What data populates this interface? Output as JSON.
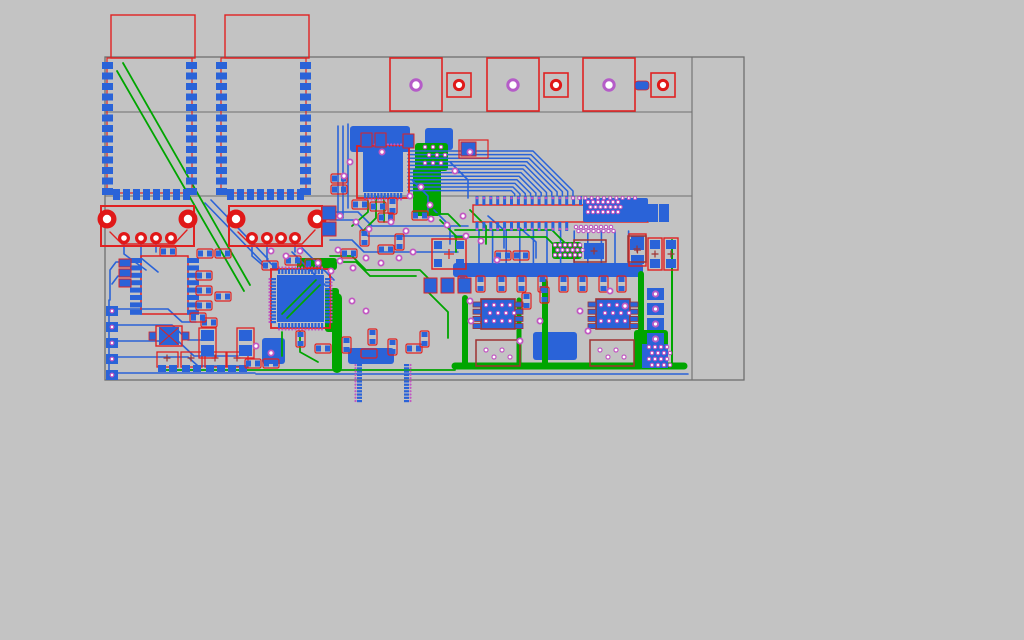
{
  "app": {
    "name": "pcb-layout-viewer"
  },
  "pcb": {
    "canvas": {
      "width": 1024,
      "height": 640,
      "background": "#c3c3c3"
    },
    "palette": {
      "board_outline": "#6f6f6f",
      "top_copper": "#2a63d8",
      "bottom_copper": "#00a500",
      "silkscreen": "#e02222",
      "silkscreen_dark": "#a03333",
      "via_ring": "#c257c2",
      "violet_ring": "#b55cc8",
      "hole_fill": "#ffffff",
      "drill_red": "#e01818"
    },
    "board": {
      "outer": {
        "x": 105,
        "y": 57,
        "w": 639,
        "h": 323
      },
      "vlines": [
        [
          692,
          57,
          692,
          380
        ]
      ],
      "hlines": [
        [
          105,
          112,
          692,
          112
        ],
        [
          105,
          196,
          692,
          196
        ]
      ]
    },
    "wifi_modules": [
      {
        "x": 107,
        "y": 58,
        "w": 85,
        "h": 135,
        "courtyard": {
          "x": 111,
          "y": 15,
          "w": 84,
          "h": 43
        }
      },
      {
        "x": 221,
        "y": 58,
        "w": 85,
        "h": 135,
        "courtyard": {
          "x": 225,
          "y": 15,
          "w": 84,
          "h": 43
        }
      }
    ],
    "mount_pads_large": [
      {
        "x": 390,
        "y": 58,
        "s": 52
      },
      {
        "x": 487,
        "y": 58,
        "s": 52
      },
      {
        "x": 583,
        "y": 58,
        "s": 52
      }
    ],
    "mount_pads_small": [
      {
        "x": 447,
        "y": 73,
        "s": 24
      },
      {
        "x": 544,
        "y": 73,
        "s": 24
      },
      {
        "x": 651,
        "y": 73,
        "s": 24
      }
    ],
    "mini_pad": {
      "x": 635,
      "y": 81,
      "w": 14,
      "h": 9
    },
    "usb_connectors": [
      {
        "x": 101,
        "y": 206,
        "w": 93,
        "h": 40,
        "holes": [
          [
            107,
            219
          ],
          [
            188,
            219
          ]
        ],
        "pins": [
          [
            124,
            238
          ],
          [
            141,
            238
          ],
          [
            156,
            238
          ],
          [
            171,
            238
          ]
        ],
        "trap": "110,232 122,244 174,244 187,230"
      },
      {
        "x": 229,
        "y": 206,
        "w": 93,
        "h": 40,
        "holes": [
          [
            236,
            219
          ],
          [
            317,
            219
          ]
        ],
        "pins": [
          [
            252,
            238
          ],
          [
            267,
            238
          ],
          [
            281,
            238
          ],
          [
            295,
            238
          ]
        ],
        "trap": "238,232 250,244 302,244 315,230"
      }
    ],
    "qfps": [
      {
        "x": 357,
        "y": 146,
        "s": 52,
        "pins": 12,
        "diag": false
      },
      {
        "x": 271,
        "y": 269,
        "s": 59,
        "pins": 14,
        "diag": true
      }
    ],
    "soic16": {
      "x": 141,
      "y": 256,
      "w": 47,
      "h": 58,
      "pads": 8
    },
    "soic8": [
      {
        "x": 481,
        "y": 299,
        "w": 34,
        "h": 30
      },
      {
        "x": 596,
        "y": 299,
        "w": 34,
        "h": 30
      }
    ],
    "header": {
      "x": 473,
      "y": 205,
      "w": 175,
      "h": 17,
      "top_pins": 16,
      "bottom_pins": 14,
      "pitch": 6.9
    },
    "castellated_block": {
      "x": 583,
      "y": 198,
      "w": 65,
      "h": 24
    },
    "tall_pads": [
      [
        648,
        204,
        10,
        18
      ],
      [
        659,
        204,
        10,
        18
      ]
    ],
    "elco_caps": [
      {
        "x": 629,
        "y": 234,
        "w": 17,
        "h": 32
      },
      {
        "x": 648,
        "y": 238,
        "w": 14,
        "h": 32
      },
      {
        "x": 664,
        "y": 238,
        "w": 14,
        "h": 32
      }
    ],
    "caps_small": [
      {
        "x": 157,
        "y": 352
      },
      {
        "x": 181,
        "y": 352
      },
      {
        "x": 205,
        "y": 352
      },
      {
        "x": 227,
        "y": 352
      }
    ],
    "red_boxes": [
      {
        "x": 476,
        "y": 340,
        "w": 44,
        "h": 26,
        "dots": true
      },
      {
        "x": 590,
        "y": 340,
        "w": 44,
        "h": 26,
        "dots": true
      },
      {
        "x": 574,
        "y": 240,
        "w": 32,
        "h": 22,
        "plus": [
          594,
          251
        ],
        "pad": [
          584,
          243,
          20,
          16
        ]
      },
      {
        "x": 628,
        "y": 236,
        "w": 18,
        "h": 26,
        "plus": [
          637,
          249
        ],
        "pad": [
          630,
          239,
          14,
          11
        ]
      }
    ],
    "trimmer": {
      "x": 432,
      "y": 239,
      "w": 34,
      "h": 30
    },
    "crystal": {
      "x": 156,
      "y": 326,
      "w": 26,
      "h": 20
    },
    "vpads2": [
      {
        "x": 237,
        "y": 328
      },
      {
        "x": 199,
        "y": 328
      }
    ],
    "passives": [
      [
        160,
        247,
        "h"
      ],
      [
        197,
        249,
        "h"
      ],
      [
        215,
        249,
        "h"
      ],
      [
        196,
        271,
        "h"
      ],
      [
        196,
        286,
        "h"
      ],
      [
        196,
        301,
        "h"
      ],
      [
        215,
        292,
        "h"
      ],
      [
        201,
        318,
        "h"
      ],
      [
        190,
        313,
        "h"
      ],
      [
        245,
        359,
        "h"
      ],
      [
        263,
        359,
        "h"
      ],
      [
        331,
        174,
        "h"
      ],
      [
        331,
        185,
        "h"
      ],
      [
        352,
        200,
        "h"
      ],
      [
        370,
        202,
        "h"
      ],
      [
        388,
        198,
        "v"
      ],
      [
        378,
        213,
        "h"
      ],
      [
        412,
        211,
        "h"
      ],
      [
        360,
        230,
        "v"
      ],
      [
        395,
        234,
        "v"
      ],
      [
        378,
        245,
        "h"
      ],
      [
        341,
        249,
        "h"
      ],
      [
        495,
        251,
        "h"
      ],
      [
        513,
        251,
        "h"
      ],
      [
        458,
        276,
        "v"
      ],
      [
        476,
        276,
        "v"
      ],
      [
        497,
        276,
        "v"
      ],
      [
        517,
        276,
        "v"
      ],
      [
        538,
        276,
        "v"
      ],
      [
        559,
        276,
        "v"
      ],
      [
        578,
        276,
        "v"
      ],
      [
        599,
        276,
        "v"
      ],
      [
        617,
        276,
        "v"
      ],
      [
        522,
        293,
        "v"
      ],
      [
        540,
        287,
        "v"
      ],
      [
        296,
        331,
        "v"
      ],
      [
        315,
        344,
        "h"
      ],
      [
        342,
        337,
        "v"
      ],
      [
        361,
        349,
        "h"
      ],
      [
        368,
        329,
        "v"
      ],
      [
        388,
        339,
        "v"
      ],
      [
        406,
        344,
        "h"
      ],
      [
        420,
        331,
        "v"
      ],
      [
        262,
        261,
        "h"
      ],
      [
        285,
        256,
        "h"
      ],
      [
        305,
        259,
        "h"
      ]
    ],
    "misc_pads": [
      {
        "x": 119,
        "y": 259,
        "w": 12,
        "h": 8,
        "o": true
      },
      {
        "x": 119,
        "y": 269,
        "w": 12,
        "h": 8,
        "o": true
      },
      {
        "x": 119,
        "y": 279,
        "w": 12,
        "h": 8,
        "o": true
      },
      {
        "x": 322,
        "y": 206,
        "w": 14,
        "h": 14,
        "o": true
      },
      {
        "x": 322,
        "y": 222,
        "w": 14,
        "h": 14,
        "o": true
      },
      {
        "x": 424,
        "y": 278,
        "w": 13,
        "h": 15,
        "o": true
      },
      {
        "x": 441,
        "y": 278,
        "w": 13,
        "h": 15,
        "o": true
      },
      {
        "x": 458,
        "y": 278,
        "w": 13,
        "h": 15,
        "o": true
      },
      {
        "x": 361,
        "y": 133,
        "w": 11,
        "h": 14,
        "o": true
      },
      {
        "x": 375,
        "y": 133,
        "w": 11,
        "h": 14,
        "o": true
      },
      {
        "x": 403,
        "y": 134,
        "w": 11,
        "h": 14,
        "o": true
      },
      {
        "x": 461,
        "y": 142,
        "w": 15,
        "h": 14,
        "o": true
      },
      {
        "x": 642,
        "y": 344,
        "w": 26,
        "h": 24,
        "o": false
      }
    ],
    "pad_extension": {
      "x": 459,
      "y": 140,
      "w": 29,
      "h": 18
    },
    "left_pad_column": {
      "x": 106,
      "y0": 306,
      "dy": 16,
      "n": 5,
      "w": 12,
      "h": 10
    },
    "right_pad_column": {
      "x": 647,
      "y0": 288,
      "dy": 15,
      "n": 4,
      "w": 17,
      "h": 12
    },
    "pours_blue": [
      [
        350,
        126,
        60,
        26
      ],
      [
        425,
        128,
        28,
        22
      ],
      [
        453,
        263,
        190,
        14
      ],
      [
        533,
        332,
        44,
        28
      ],
      [
        262,
        338,
        23,
        26
      ],
      [
        348,
        348,
        46,
        16
      ]
    ],
    "pours_green": [
      [
        415,
        143,
        33,
        28
      ],
      [
        413,
        168,
        28,
        48
      ],
      [
        552,
        242,
        30,
        17
      ],
      [
        297,
        258,
        40,
        12
      ],
      [
        325,
        288,
        14,
        44
      ],
      [
        634,
        330,
        34,
        38
      ]
    ],
    "traces_blue": [
      "114,309 168,309 182,322 196,322",
      "114,325 172,325 188,340 210,340",
      "114,341 178,341 194,356 238,356",
      "114,357 188,357 198,366 248,366",
      "114,373 255,373",
      "109,300 109,374",
      "130,262 116,262 110,270 110,300",
      "130,276 118,276 112,284",
      "124,244 124,254 146,270",
      "141,244 141,258 158,272",
      "156,244 156,252",
      "252,244 252,256 266,268",
      "267,244 267,260 278,270",
      "295,244 295,252",
      "338,126 338,214",
      "343,126 343,218",
      "348,124 348,208",
      "332,212 358,212 372,226 468,226",
      "330,220 354,220 368,236 464,236",
      "330,240 352,240 364,252 458,252",
      "302,248 334,280",
      "292,252 326,286",
      "205,203 262,262",
      "211,200 268,259",
      "412,180 428,196 428,212",
      "450,162 468,180 468,198",
      "434,210 450,226 450,244",
      "488,216 504,230 504,248",
      "520,228 536,242 536,258",
      "256,374 688,374"
    ],
    "traces_green": [
      "123,63 250,285",
      "117,71 244,291",
      "368,197 368,212 352,226",
      "376,197 376,218 362,232",
      "384,197 384,222",
      "455,230 552,230 564,242 572,248",
      "455,237 546,237 558,249",
      "418,214 448,214 460,226",
      "300,332 300,352 318,362",
      "282,332 282,356",
      "428,292 448,312 448,338",
      "330,256 352,256 366,270 420,270 432,282 432,292",
      "336,262 356,262 370,276 416,276",
      "440,220 456,236 456,252",
      "470,210 486,226 486,244",
      "160,370 455,370"
    ],
    "traces_green_thick": [
      {
        "pts": "455,366 684,366",
        "w": 7
      },
      {
        "pts": "545,366 545,282",
        "w": 6
      },
      {
        "pts": "641,366 641,274",
        "w": 6
      },
      {
        "pts": "337,368 337,298",
        "w": 10
      },
      {
        "pts": "465,366 465,298",
        "w": 6
      },
      {
        "pts": "519,366 519,300",
        "w": 5
      },
      {
        "pts": "672,364 672,240",
        "w": 2
      }
    ],
    "fan": {
      "x0": 408,
      "y0": 151,
      "n": 12,
      "dy": 3.6,
      "dropx0": 573,
      "dropdx": -5.3,
      "diag0": 40,
      "diagd": -3.3,
      "endy": 196
    },
    "header_drops": {
      "x0": 479,
      "dx": 13.6,
      "n": 12,
      "y1": 231,
      "y2": 263
    },
    "dot_rows": [
      {
        "x0": 573,
        "dx": 6.2,
        "n": 11,
        "y": 198
      }
    ],
    "via_clusters": [
      {
        "x": 588,
        "y": 202,
        "cols": 7,
        "rows": 3,
        "dx": 5,
        "dy": 5
      },
      {
        "x": 576,
        "y": 227,
        "cols": 8,
        "rows": 2,
        "dx": 5,
        "dy": 4
      },
      {
        "x": 425,
        "y": 147,
        "cols": 3,
        "rows": 3,
        "dx": 8,
        "dy": 8
      },
      {
        "x": 555,
        "y": 245,
        "cols": 6,
        "rows": 3,
        "dx": 5,
        "dy": 5
      },
      {
        "x": 649,
        "y": 347,
        "cols": 4,
        "rows": 4,
        "dx": 6,
        "dy": 6
      },
      {
        "x": 486,
        "y": 305,
        "cols": 4,
        "rows": 3,
        "dx": 8,
        "dy": 8
      },
      {
        "x": 601,
        "y": 305,
        "cols": 4,
        "rows": 3,
        "dx": 8,
        "dy": 8
      }
    ],
    "vias": [
      [
        350,
        162
      ],
      [
        344,
        176
      ],
      [
        410,
        196
      ],
      [
        421,
        187
      ],
      [
        455,
        171
      ],
      [
        470,
        152
      ],
      [
        340,
        216
      ],
      [
        356,
        222
      ],
      [
        369,
        229
      ],
      [
        391,
        222
      ],
      [
        406,
        231
      ],
      [
        431,
        219
      ],
      [
        447,
        225
      ],
      [
        463,
        216
      ],
      [
        340,
        261
      ],
      [
        353,
        268
      ],
      [
        366,
        258
      ],
      [
        381,
        263
      ],
      [
        399,
        258
      ],
      [
        413,
        252
      ],
      [
        300,
        251
      ],
      [
        286,
        256
      ],
      [
        271,
        251
      ],
      [
        466,
        236
      ],
      [
        481,
        241
      ],
      [
        256,
        346
      ],
      [
        271,
        353
      ],
      [
        470,
        301
      ],
      [
        540,
        321
      ],
      [
        580,
        311
      ],
      [
        471,
        321
      ],
      [
        610,
        291
      ],
      [
        625,
        306
      ],
      [
        588,
        331
      ],
      [
        520,
        341
      ],
      [
        352,
        301
      ],
      [
        366,
        311
      ],
      [
        331,
        271
      ],
      [
        318,
        263
      ],
      [
        497,
        260
      ],
      [
        430,
        205
      ],
      [
        382,
        152
      ],
      [
        338,
        250
      ]
    ]
  }
}
